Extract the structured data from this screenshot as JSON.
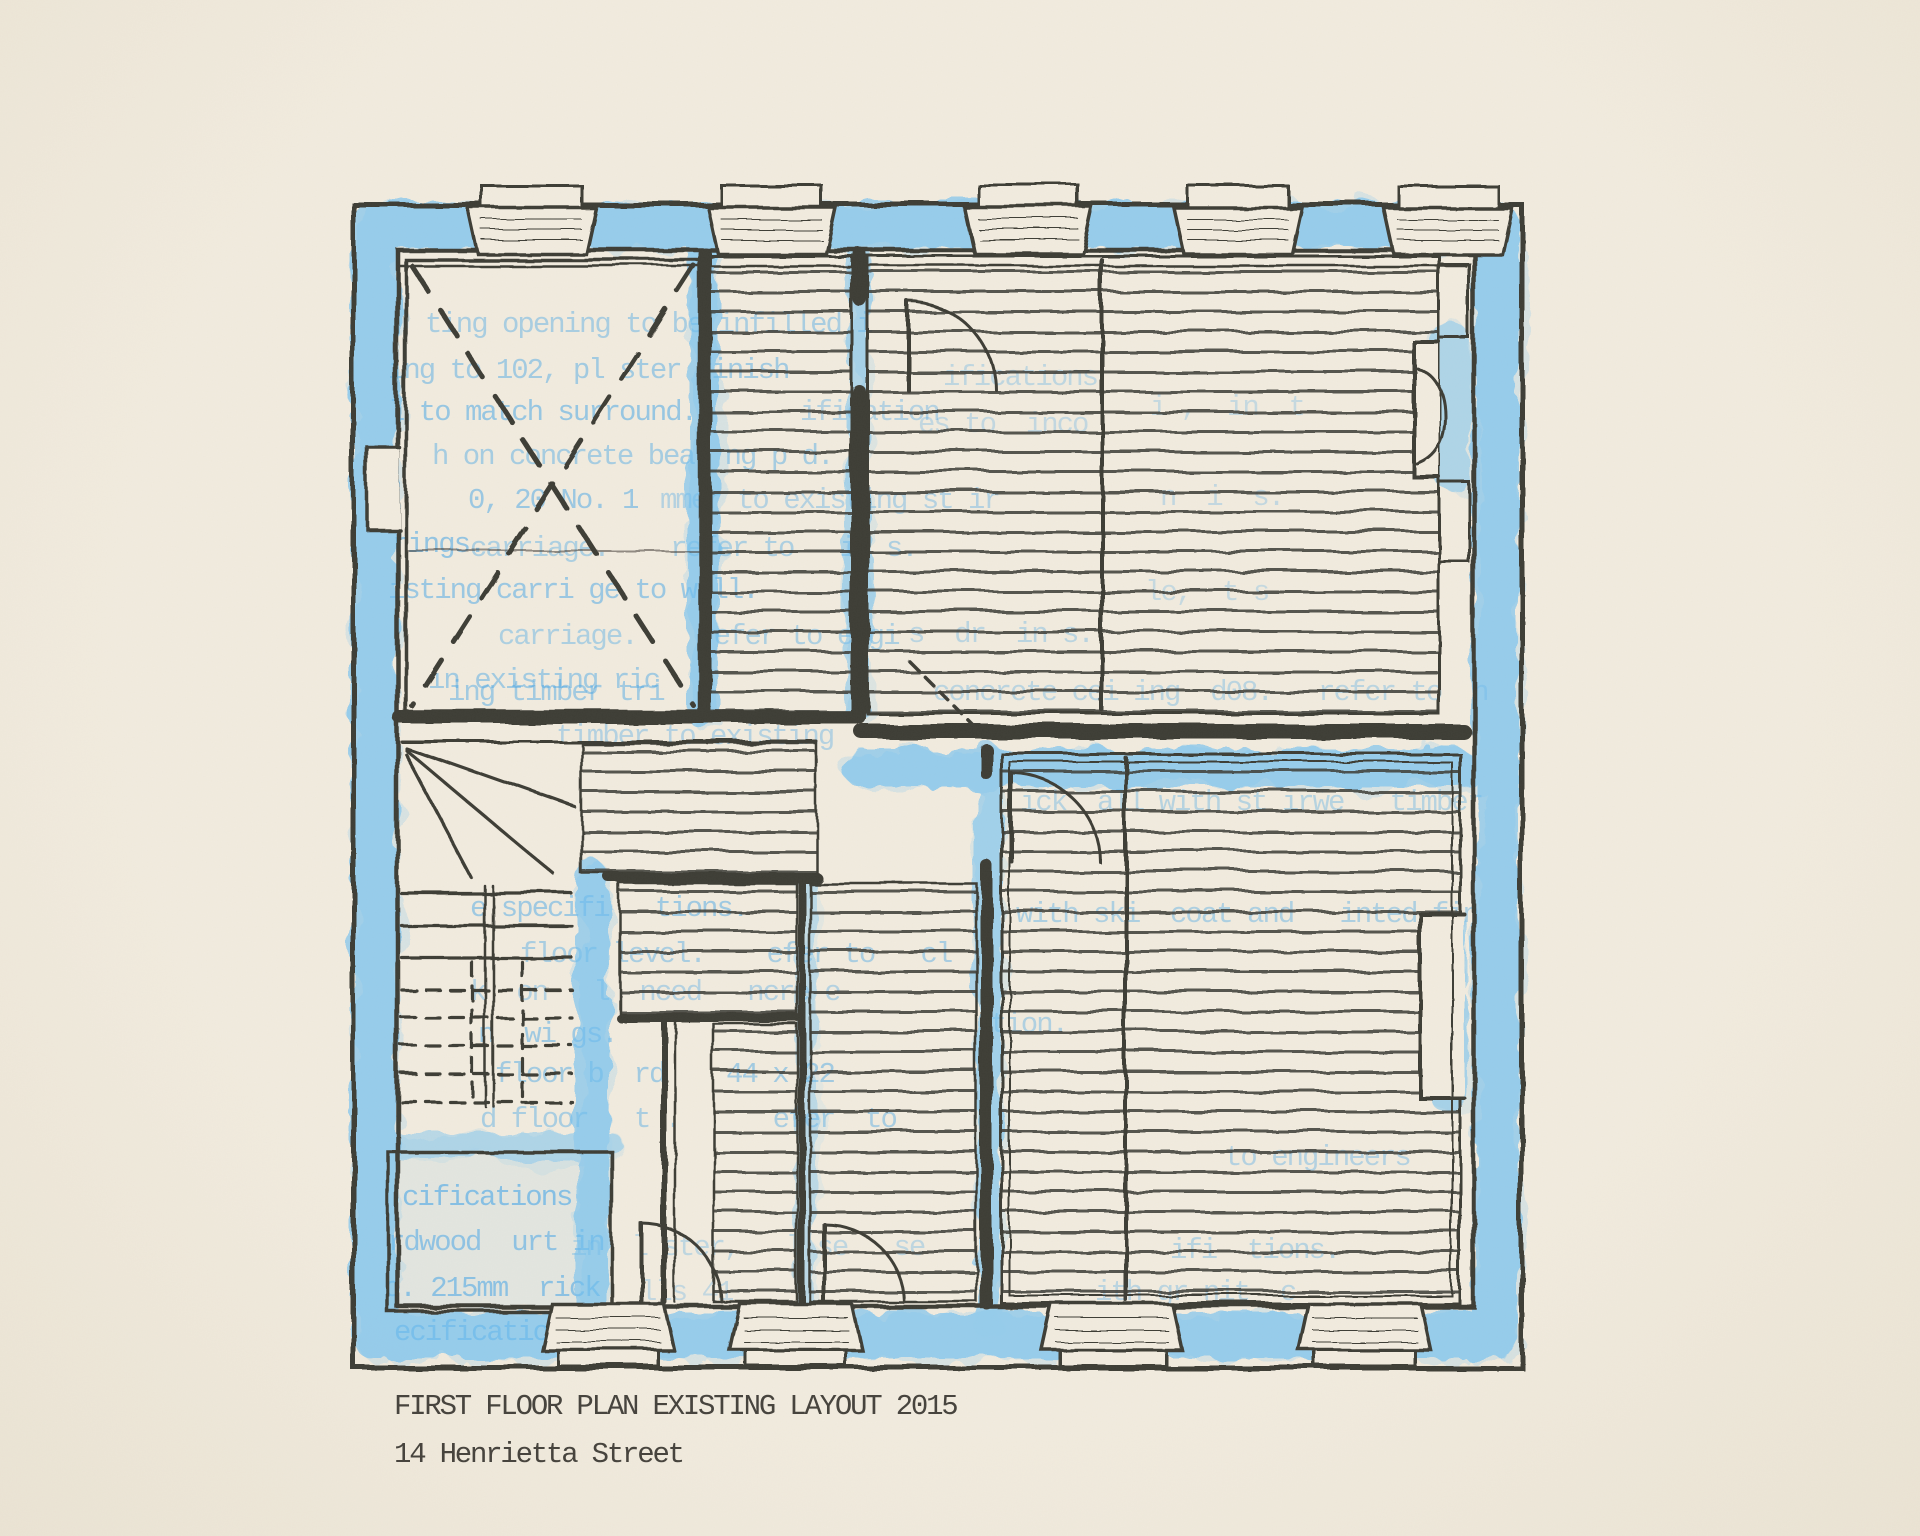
{
  "artwork": {
    "type": "floor-plan-print",
    "caption": {
      "line1": "FIRST FLOOR PLAN EXISTING LAYOUT 2015",
      "line2": "14 Henrietta Street"
    },
    "colors": {
      "paper": "#f2ecdf",
      "paper_edge": "#ebe4d4",
      "ink": "#3e3c36",
      "caption_ink": "#45423c",
      "crayon_blue": "#6fc0f2",
      "type_blue": "#3fa3e8"
    },
    "spec_fragments": [
      {
        "x": 425,
        "y": 332,
        "text": "ting opening to be infilled i",
        "opacity": 0.4
      },
      {
        "x": 388,
        "y": 378,
        "text": "ing to 102, pl ster finish",
        "opacity": 0.44
      },
      {
        "x": 388,
        "y": 420,
        "text": "l to match surround.",
        "opacity": 0.5
      },
      {
        "x": 800,
        "y": 420,
        "text": "ification",
        "opacity": 0.34
      },
      {
        "x": 432,
        "y": 464,
        "text": "h on concrete bear ng p d.",
        "opacity": 0.42
      },
      {
        "x": 468,
        "y": 508,
        "text": "0, 20 No. 1",
        "opacity": 0.48
      },
      {
        "x": 660,
        "y": 508,
        "text": "mmer to existing st ir",
        "opacity": 0.34
      },
      {
        "x": 392,
        "y": 552,
        "text": "rings.",
        "opacity": 0.52
      },
      {
        "x": 470,
        "y": 556,
        "text": "carriage.    refer to   in s.",
        "opacity": 0.38
      },
      {
        "x": 388,
        "y": 598,
        "text": "isting carri ge to w ll.",
        "opacity": 0.48
      },
      {
        "x": 498,
        "y": 644,
        "text": "carriage.    refer to engi",
        "opacity": 0.38
      },
      {
        "x": 908,
        "y": 642,
        "text": "s  dr  in s.",
        "opacity": 0.3
      },
      {
        "x": 933,
        "y": 700,
        "text": "concrete cei ing  d08.   refer to  n",
        "opacity": 0.3
      },
      {
        "x": 428,
        "y": 688,
        "text": "in existing ric",
        "opacity": 0.44
      },
      {
        "x": 448,
        "y": 700,
        "text": "ing timber tri",
        "opacity": 0.44
      },
      {
        "x": 556,
        "y": 744,
        "text": "timber to existing",
        "opacity": 0.34
      },
      {
        "x": 943,
        "y": 385,
        "text": "ifications",
        "opacity": 0.28
      },
      {
        "x": 918,
        "y": 432,
        "text": "es to  inco",
        "opacity": 0.26
      },
      {
        "x": 1150,
        "y": 415,
        "text": "i ,  in  t",
        "opacity": 0.24
      },
      {
        "x": 1160,
        "y": 505,
        "text": "n  i  s.",
        "opacity": 0.26
      },
      {
        "x": 1145,
        "y": 600,
        "text": "le,  t s",
        "opacity": 0.24
      },
      {
        "x": 1020,
        "y": 810,
        "text": "ick  all with st irwe   timber",
        "opacity": 0.32
      },
      {
        "x": 1016,
        "y": 922,
        "text": "with ski  coat and   inted fin",
        "opacity": 0.38
      },
      {
        "x": 470,
        "y": 916,
        "text": "e specifi   tions.",
        "opacity": 0.46
      },
      {
        "x": 520,
        "y": 962,
        "text": "floor level.    efer to   cl",
        "opacity": 0.4
      },
      {
        "x": 990,
        "y": 1032,
        "text": "tion.",
        "opacity": 0.36
      },
      {
        "x": 470,
        "y": 1000,
        "text": "k  on   l  nced   ncre e",
        "opacity": 0.34
      },
      {
        "x": 478,
        "y": 1042,
        "text": "n  wi gs.",
        "opacity": 0.46
      },
      {
        "x": 495,
        "y": 1082,
        "text": "floor b  rd    44 x 22",
        "opacity": 0.44
      },
      {
        "x": 480,
        "y": 1127,
        "text": "d floor   t .      efer  to",
        "opacity": 0.4
      },
      {
        "x": 1225,
        "y": 1165,
        "text": "to engineers",
        "opacity": 0.34
      },
      {
        "x": 402,
        "y": 1205,
        "text": "cifications",
        "opacity": 0.58
      },
      {
        "x": 388,
        "y": 1250,
        "text": "rdwood  urt in",
        "opacity": 0.52
      },
      {
        "x": 570,
        "y": 1255,
        "text": "in  l ster,   l se   se",
        "opacity": 0.28
      },
      {
        "x": 1170,
        "y": 1258,
        "text": "ifi  tions.",
        "opacity": 0.32
      },
      {
        "x": 384,
        "y": 1296,
        "text": "o. 215mm  rick",
        "opacity": 0.54
      },
      {
        "x": 640,
        "y": 1300,
        "text": "lls 41",
        "opacity": 0.26
      },
      {
        "x": 1095,
        "y": 1300,
        "text": "ith gr nit  c",
        "opacity": 0.3
      },
      {
        "x": 394,
        "y": 1340,
        "text": "ecifications",
        "opacity": 0.56
      }
    ]
  }
}
